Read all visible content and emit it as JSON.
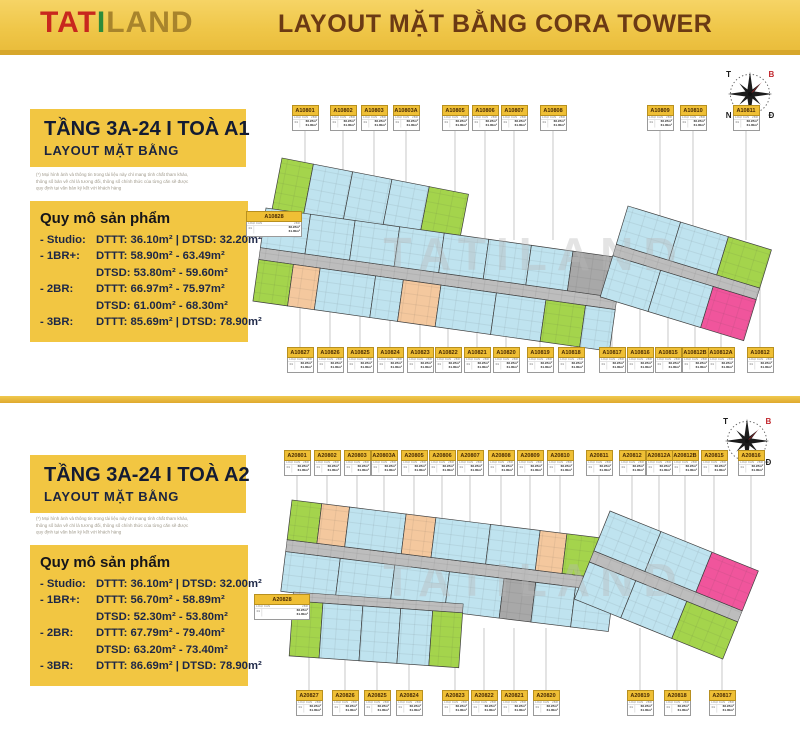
{
  "header": {
    "logo_tat": "TAT",
    "logo_i": "I",
    "logo_land": "LAND",
    "title": "LAYOUT MẶT BẰNG CORA TOWER"
  },
  "watermark": "TATILAND",
  "compass": {
    "nw": "T",
    "ne": "B",
    "sw": "N",
    "se": "Đ"
  },
  "label_card": {
    "type_label": "LOẠI CĂN",
    "type_value": "2BR",
    "stack": "01",
    "area1": "66.97m²",
    "area2": "61.00m²"
  },
  "sections": [
    {
      "title": "TẦNG 3A-24  I  TOÀ A1",
      "subtitle": "LAYOUT MẶT BẰNG",
      "disclaimer": [
        "(*) Mọi hình ảnh và thông tin trong tài liệu này chỉ mang tính chất tham khảo,",
        "thông số bản vẽ chỉ là tương đối, thông số chính thức của từng căn sẽ được",
        "quy định tại văn bản ký kết với khách hàng"
      ],
      "scale_title": "Quy mô sản phẩm",
      "scale_rows": [
        {
          "label": "- Studio:",
          "lines": [
            "DTTT: 36.10m² | DTSD: 32.20m²"
          ]
        },
        {
          "label": "- 1BR+:",
          "lines": [
            "DTTT: 58.90m² - 63.49m²",
            "DTSD: 53.80m² - 59.60m²"
          ]
        },
        {
          "label": "- 2BR:",
          "lines": [
            "DTTT: 66.97m² - 75.97m²",
            "DTSD: 61.00m² - 68.30m²"
          ]
        },
        {
          "label": "- 3BR:",
          "lines": [
            "DTTT: 85.69m² | DTSD: 78.90m²"
          ]
        }
      ],
      "units_top": [
        [
          "A10801",
          305
        ],
        [
          "A10802",
          343
        ],
        [
          "A10803",
          374
        ],
        [
          "A10803A",
          406
        ],
        [
          "A10805",
          455
        ],
        [
          "A10806",
          485
        ],
        [
          "A10807",
          514
        ],
        [
          "A10808",
          553
        ],
        [
          "A10809",
          660
        ],
        [
          "A10810",
          693
        ],
        [
          "A10811",
          746
        ]
      ],
      "units_bottom": [
        [
          "A10827",
          300
        ],
        [
          "A10826",
          330
        ],
        [
          "A10825",
          360
        ],
        [
          "A10824",
          390
        ],
        [
          "A10823",
          420
        ],
        [
          "A10822",
          448
        ],
        [
          "A10821",
          477
        ],
        [
          "A10820",
          506
        ],
        [
          "A10819",
          540
        ],
        [
          "A10818",
          571
        ],
        [
          "A10817",
          612
        ],
        [
          "A10816",
          640
        ],
        [
          "A10815",
          668
        ],
        [
          "A10812B",
          695
        ],
        [
          "A10812A",
          721
        ],
        [
          "A10812",
          760
        ]
      ],
      "unit_side": {
        "code": "A10828",
        "cx": 274,
        "y": 156
      }
    },
    {
      "title": "TẦNG 3A-24  I  TOÀ A2",
      "subtitle": "LAYOUT MẶT BẰNG",
      "disclaimer": [
        "(*) Mọi hình ảnh và thông tin trong tài liệu này chỉ mang tính chất tham khảo,",
        "thông số bản vẽ chỉ là tương đối, thông số chính thức của từng căn sẽ được",
        "quy định tại văn bản ký kết với khách hàng"
      ],
      "scale_title": "Quy mô sản phẩm",
      "scale_rows": [
        {
          "label": "- Studio:",
          "lines": [
            "DTTT: 36.10m² | DTSD: 32.00m²"
          ]
        },
        {
          "label": "- 1BR+:",
          "lines": [
            "DTTT: 56.70m² - 58.89m²",
            "DTSD: 52.30m² - 53.80m²"
          ]
        },
        {
          "label": "- 2BR:",
          "lines": [
            "DTTT: 67.79m² - 79.40m²",
            "DTSD: 63.20m² - 73.40m²"
          ]
        },
        {
          "label": "- 3BR:",
          "lines": [
            "DTTT: 86.69m² | DTSD: 78.90m²"
          ]
        }
      ],
      "units_top": [
        [
          "A20801",
          297
        ],
        [
          "A20802",
          327
        ],
        [
          "A20803",
          357
        ],
        [
          "A20803A",
          384
        ],
        [
          "A20805",
          414
        ],
        [
          "A20806",
          442
        ],
        [
          "A20807",
          470
        ],
        [
          "A20808",
          501
        ],
        [
          "A20809",
          530
        ],
        [
          "A20810",
          560
        ],
        [
          "A20811",
          599
        ],
        [
          "A20812",
          632
        ],
        [
          "A20812A",
          659
        ],
        [
          "A20812B",
          685
        ],
        [
          "A20815",
          714
        ],
        [
          "A20816",
          751
        ]
      ],
      "units_bottom": [
        [
          "A20827",
          309
        ],
        [
          "A20826",
          345
        ],
        [
          "A20825",
          377
        ],
        [
          "A20824",
          409
        ],
        [
          "A20823",
          455
        ],
        [
          "A20822",
          484
        ],
        [
          "A20821",
          514
        ],
        [
          "A20820",
          546
        ],
        [
          "A20819",
          640
        ],
        [
          "A20818",
          677
        ],
        [
          "A20817",
          722
        ]
      ],
      "unit_side": {
        "code": "A20828",
        "cx": 282,
        "y": 191
      }
    }
  ]
}
